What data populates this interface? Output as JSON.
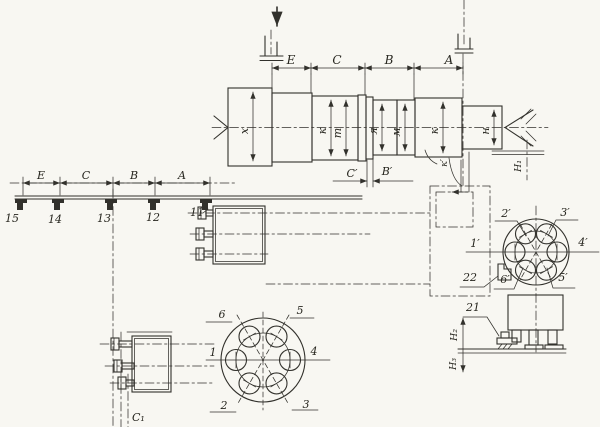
{
  "palette": {
    "background": "#f8f7f2",
    "ink": "#32312c"
  },
  "top_dim": {
    "e": "E",
    "c": "C",
    "b": "B",
    "a": "A"
  },
  "rail_dim": {
    "e": "E",
    "c": "C",
    "b": "B",
    "a": "A"
  },
  "shaft": {
    "letters": [
      "х",
      "к",
      "т",
      "я",
      "м",
      "к",
      "н"
    ],
    "k_prime": "к′"
  },
  "aux": {
    "c_prime": "C′",
    "b_prime": "B′",
    "c1": "C₁",
    "h_tail": "H₁",
    "h_base_top": "H₂",
    "h_base_bottom": "H₃"
  },
  "dogs": {
    "nums": [
      "15",
      "14",
      "13",
      "12",
      "11"
    ],
    "rear_dog": "22",
    "base_dog": "21"
  },
  "front_view": {
    "nums": [
      "1",
      "2",
      "3",
      "4",
      "5",
      "6"
    ]
  },
  "rear_view": {
    "nums": [
      "1′",
      "2′",
      "3′",
      "4′",
      "5′",
      "6′"
    ]
  }
}
